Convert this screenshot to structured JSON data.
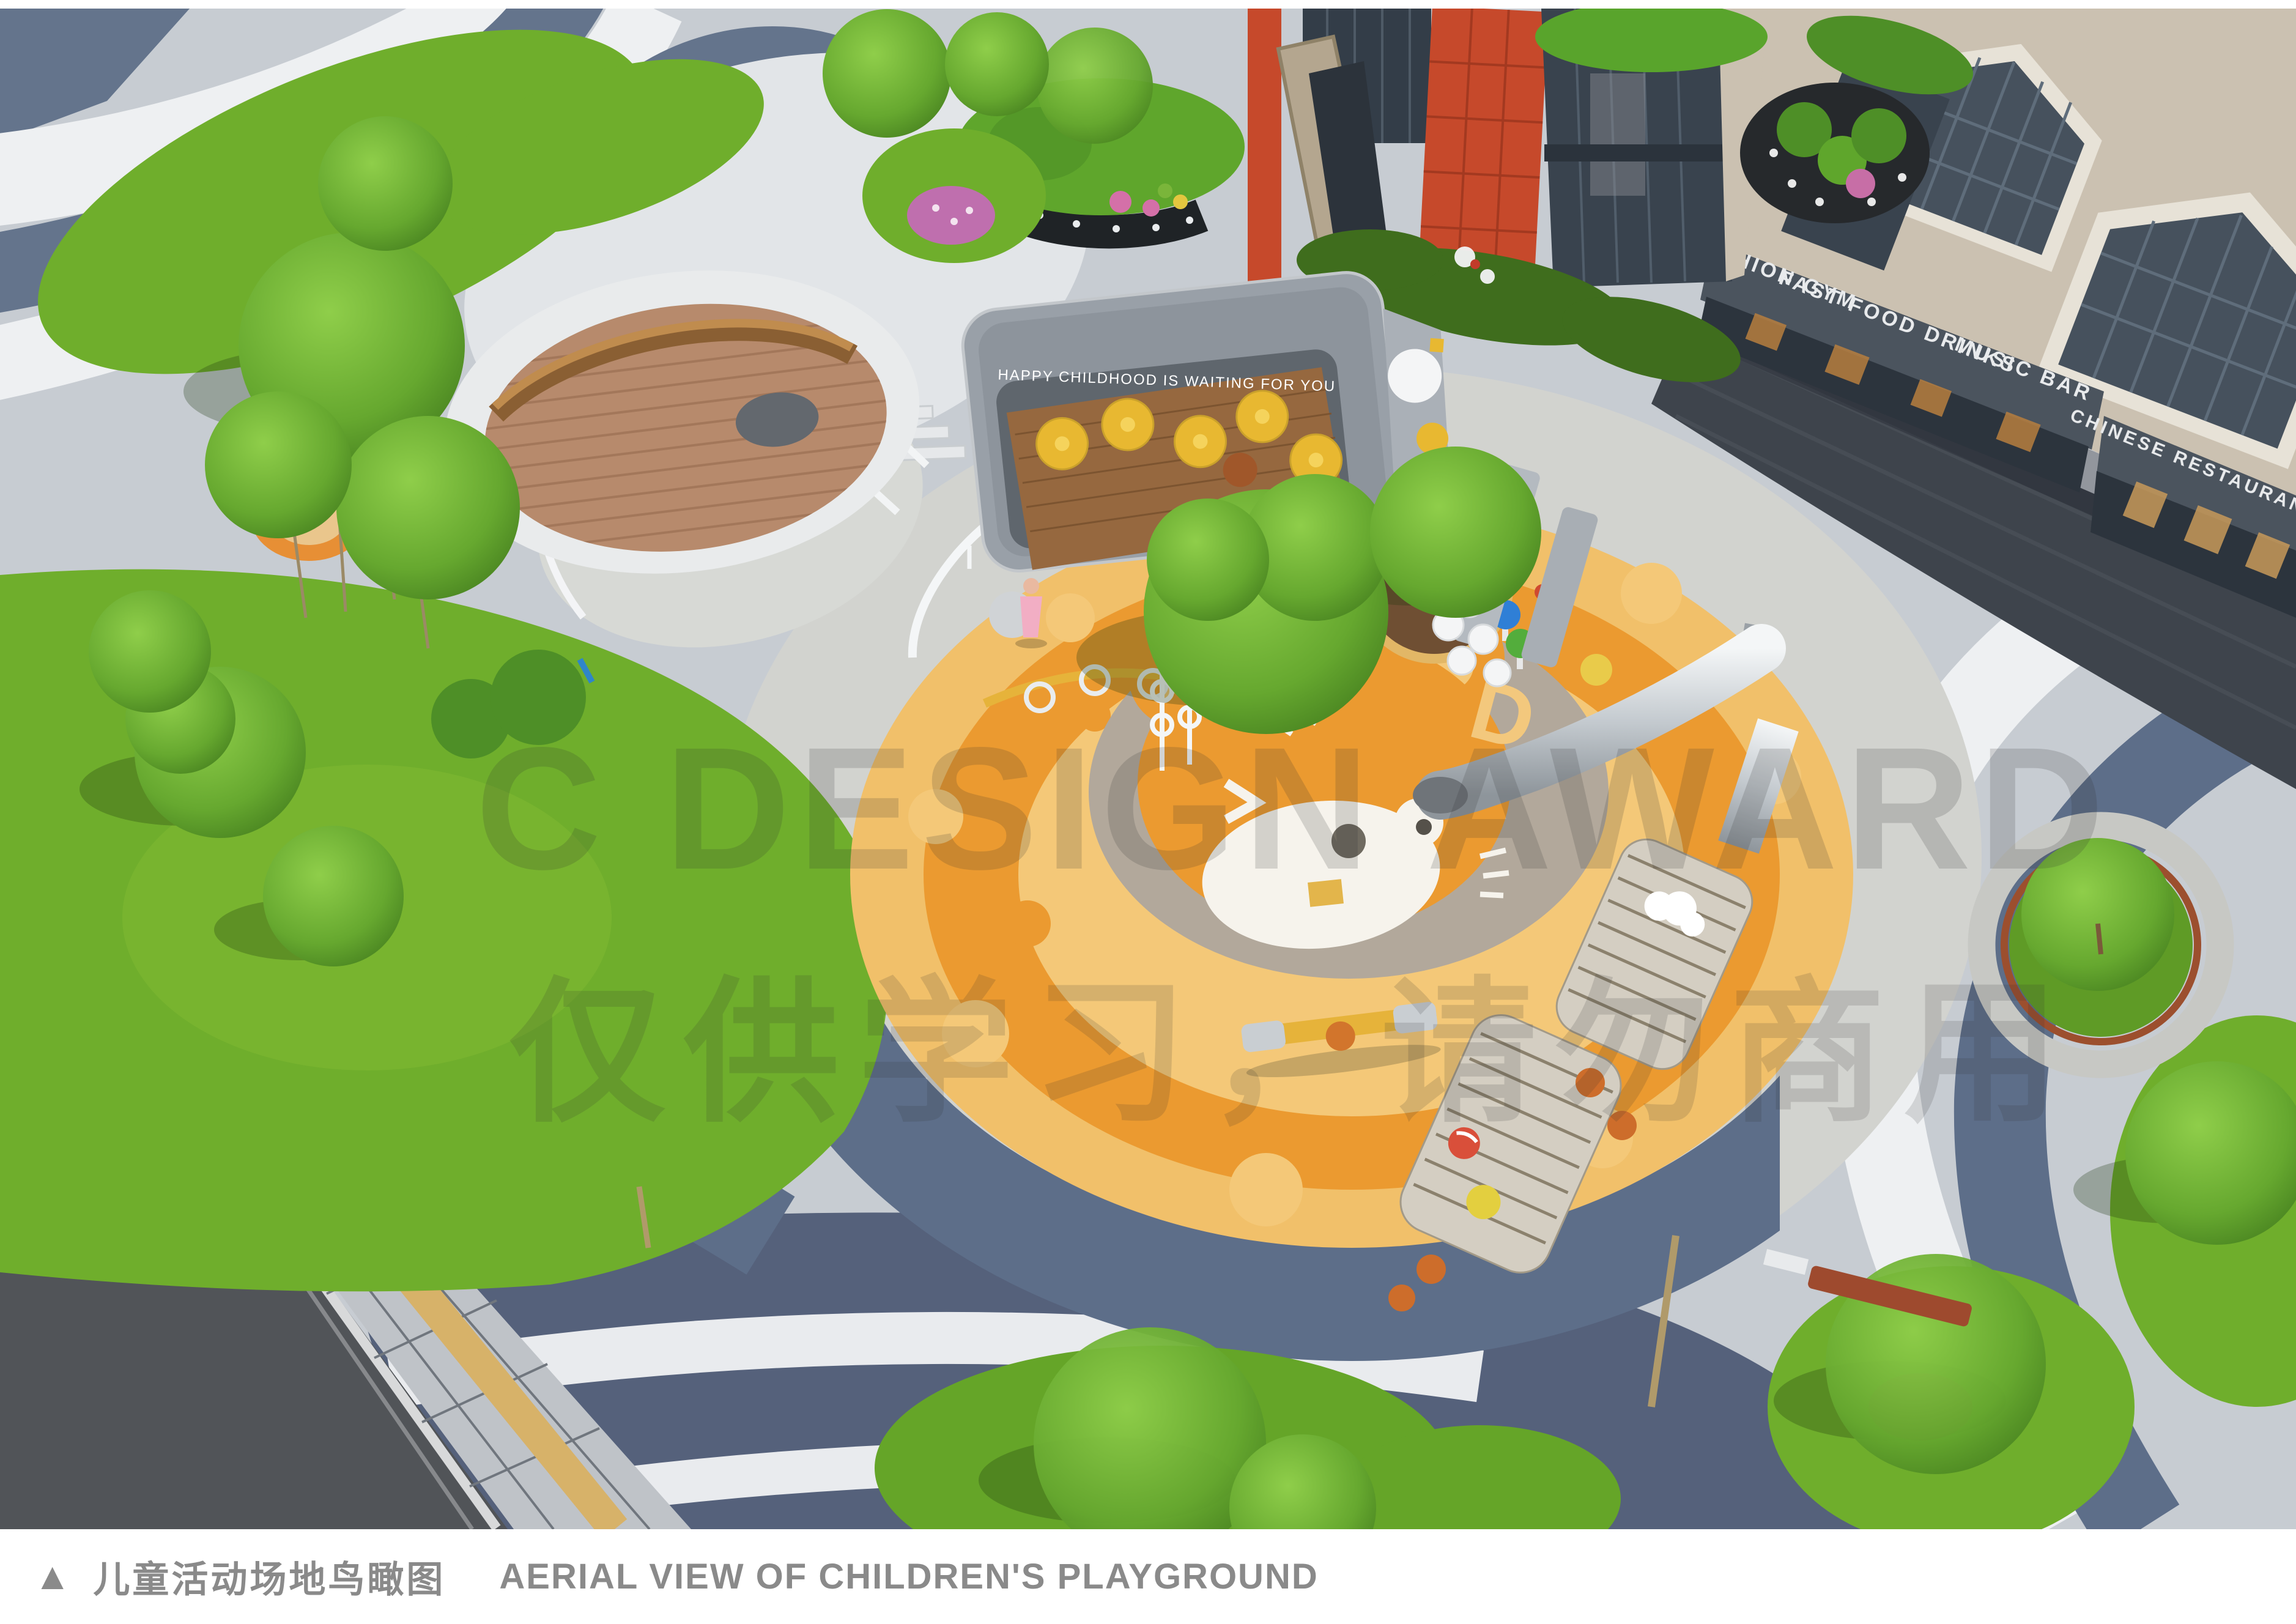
{
  "watermark": {
    "line1": "C DESIGN AWARD",
    "line2": "仅供学习，请勿商用"
  },
  "photo": {
    "pavilion_slogan": "HAPPY CHILDHOOD IS WAITING FOR YOU",
    "bear_letter": "D",
    "shop_signs": [
      {
        "label": "FASHION GYM"
      },
      {
        "label": "FAST FOOD DRINKS"
      },
      {
        "label": "MUSIC BAR"
      },
      {
        "label": "CHINESE RESTAURANT"
      }
    ],
    "colors": {
      "playground_orange": "#EB9A30",
      "playground_amber": "#F4C878",
      "lawn_green": "#6FAE2C",
      "path_slate": "#5D6E89",
      "path_white": "#EEF0F2",
      "paving_light": "#C7CCD2",
      "street_dark": "#3E444C",
      "shop_awning": "#4B545E",
      "red_facade": "#C6492B",
      "caption_gray": "#8A8A8A"
    }
  },
  "caption": {
    "marker": "▲",
    "title_cn": "儿童活动场地鸟瞰图",
    "title_en": "AERIAL VIEW OF CHILDREN'S PLAYGROUND"
  }
}
